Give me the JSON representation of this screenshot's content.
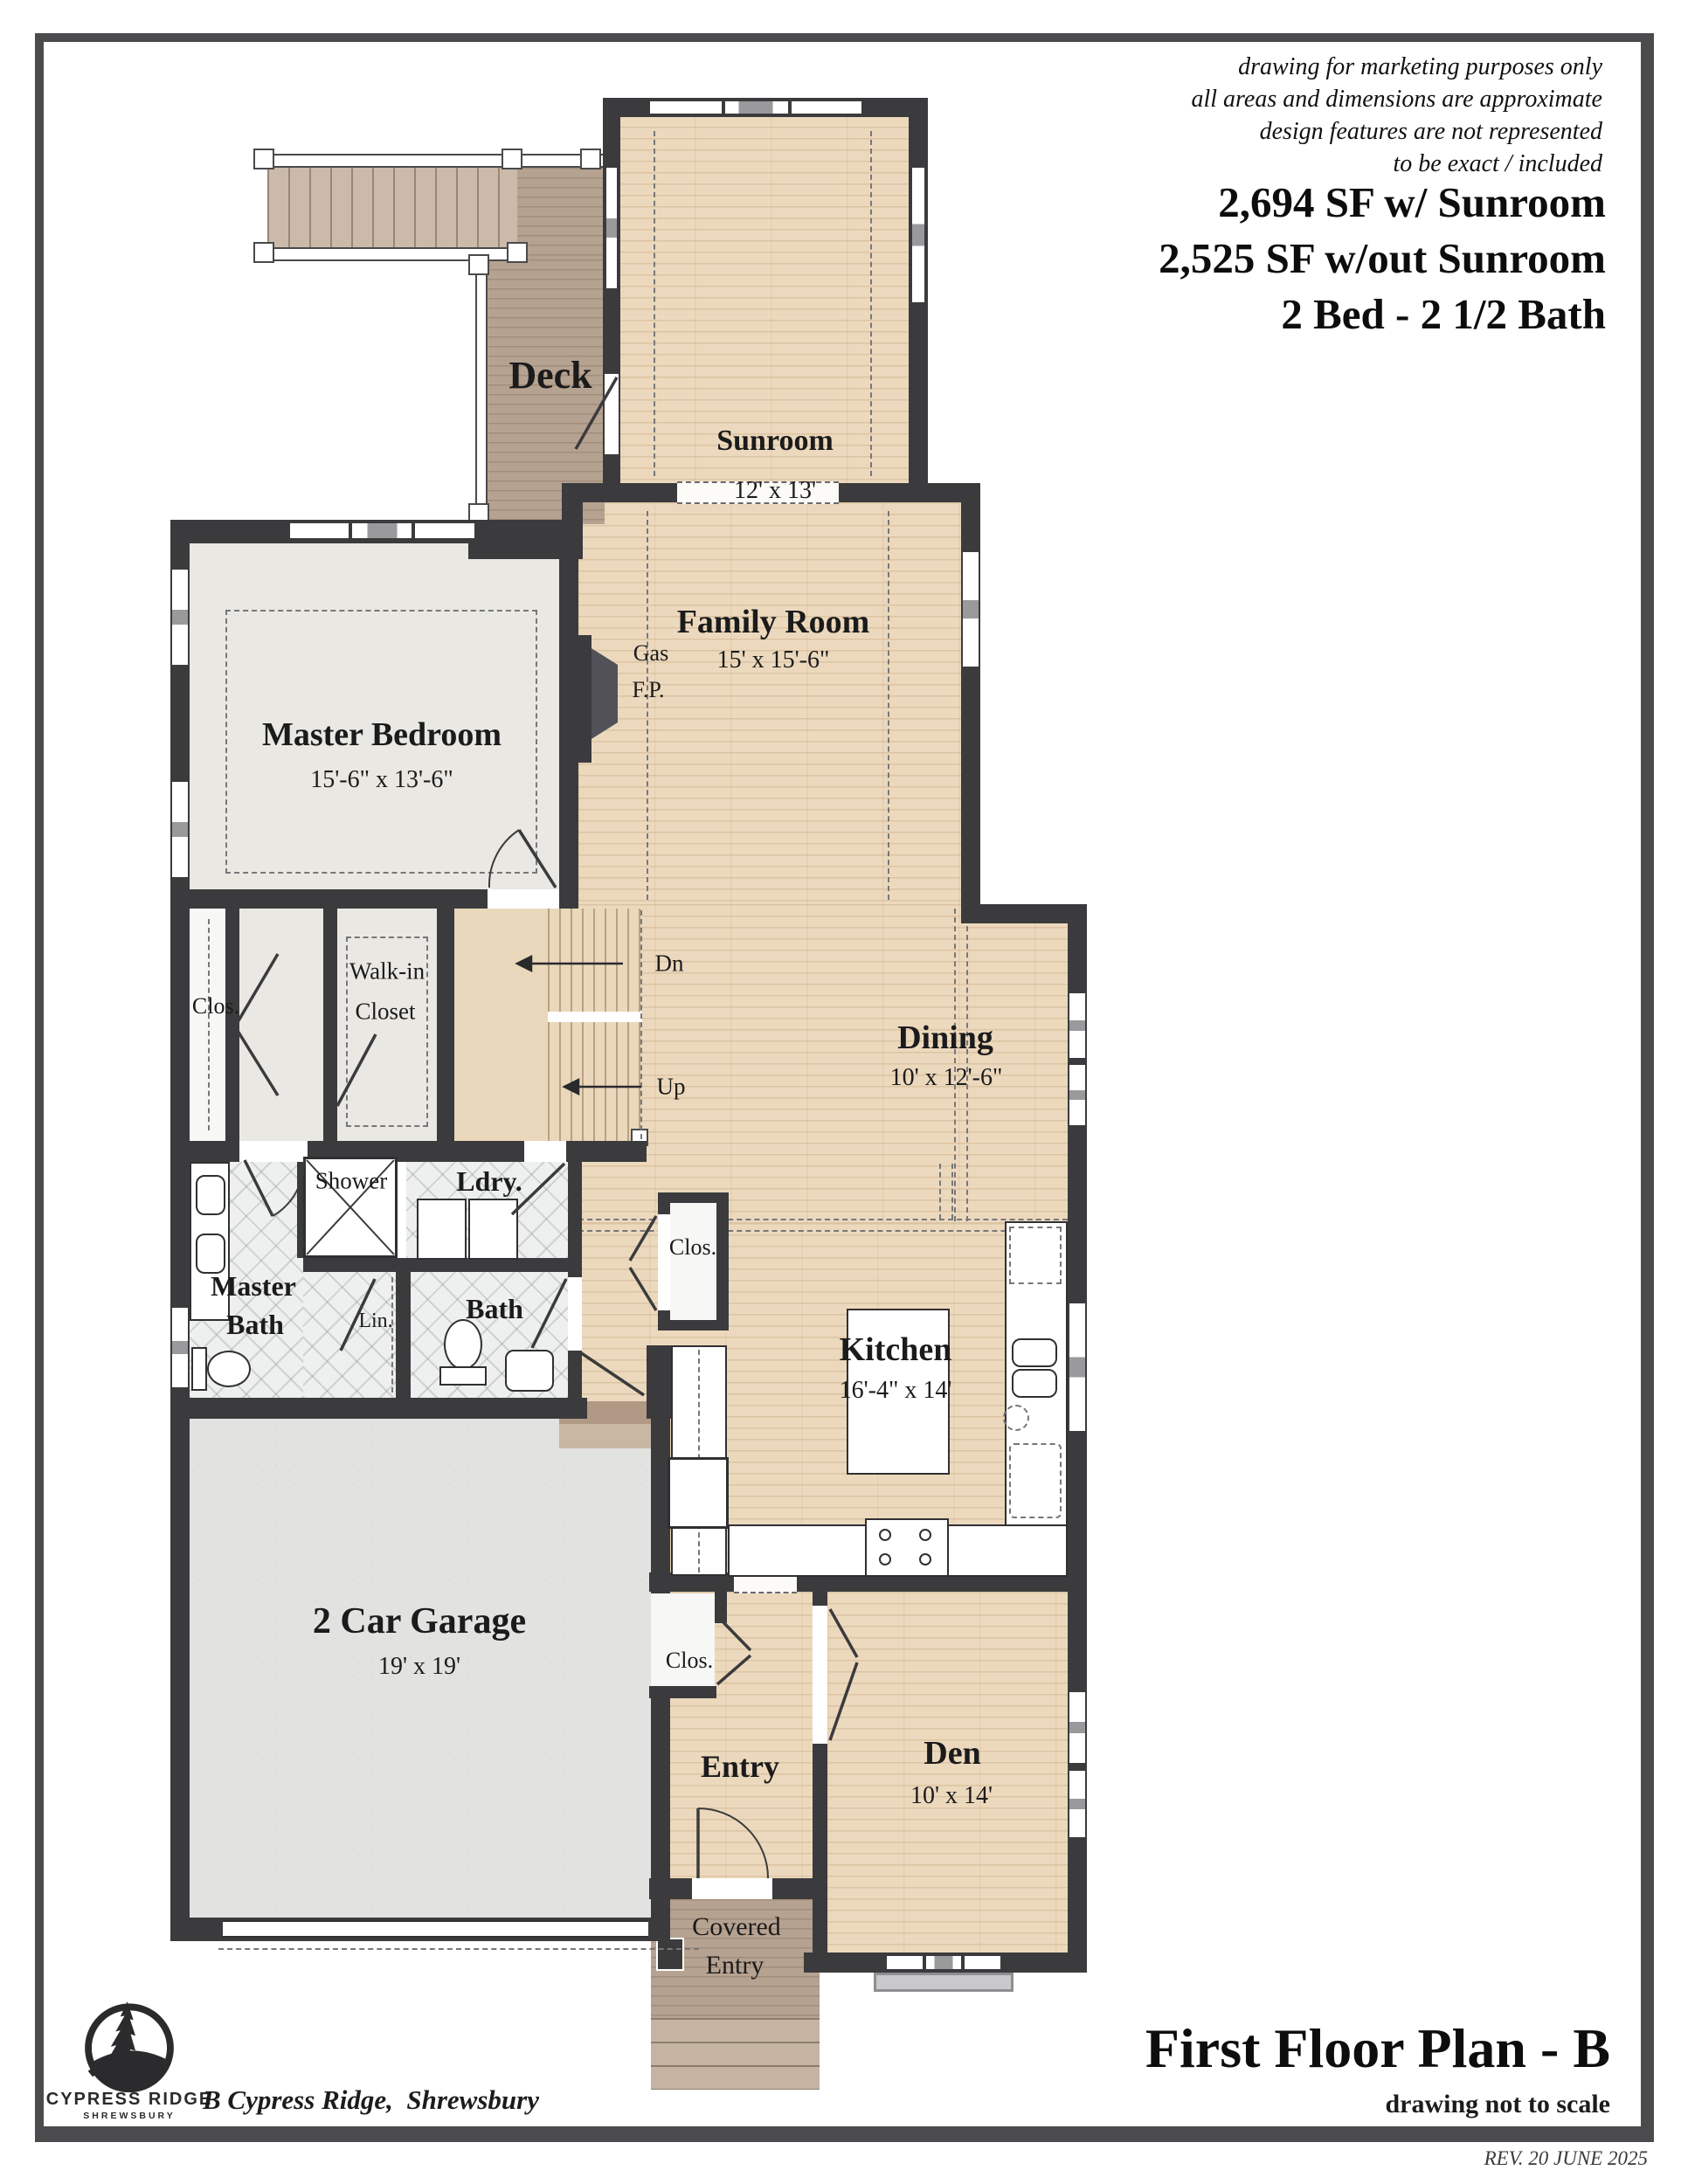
{
  "header": {
    "disclaimer_lines": [
      "drawing for marketing purposes only",
      "all areas and dimensions are approximate",
      "design features are not represented",
      "to be exact / included"
    ],
    "area_with_sunroom": "2,694 SF w/ Sunroom",
    "area_without_sunroom": "2,525 SF w/out Sunroom",
    "bed_bath": "2 Bed - 2 1/2 Bath"
  },
  "rooms": {
    "sunroom": {
      "name": "Sunroom",
      "dims": "12' x 13'"
    },
    "deck": {
      "name": "Deck"
    },
    "family_room": {
      "name": "Family Room",
      "dims": "15' x 15'-6\""
    },
    "master_bedroom": {
      "name": "Master Bedroom",
      "dims": "15'-6\" x 13'-6\""
    },
    "gas_fp": {
      "line1": "Gas",
      "line2": "F.P."
    },
    "closet_master": {
      "name": "Clos."
    },
    "walk_in_closet": {
      "line1": "Walk-in",
      "line2": "Closet"
    },
    "stairs": {
      "down": "Dn",
      "up": "Up"
    },
    "dining": {
      "name": "Dining",
      "dims": "10' x 12'-6\""
    },
    "laundry": {
      "name": "Ldry."
    },
    "shower": {
      "name": "Shower"
    },
    "master_bath": {
      "line1": "Master",
      "line2": "Bath"
    },
    "linen": {
      "name": "Lin."
    },
    "bath": {
      "name": "Bath"
    },
    "closet_hall": {
      "name": "Clos."
    },
    "kitchen": {
      "name": "Kitchen",
      "dims": "16'-4\" x 14'"
    },
    "garage": {
      "name": "2 Car Garage",
      "dims": "19' x 19'"
    },
    "closet_entry": {
      "name": "Clos."
    },
    "entry": {
      "name": "Entry"
    },
    "den": {
      "name": "Den",
      "dims": "10' x 14'"
    },
    "covered_entry": {
      "line1": "Covered",
      "line2": "Entry"
    }
  },
  "footer": {
    "logo_name": "CYPRESS RIDGE",
    "logo_sub": "SHREWSBURY",
    "address": "B Cypress Ridge,  Shrewsbury",
    "plan_title": "First Floor Plan - B",
    "scale_note": "drawing not to scale",
    "revision": "REV. 20 JUNE 2025"
  },
  "colors": {
    "wall": "#3b3b3d",
    "wood": "#ecd9bd",
    "carpet": "#e9e8e3",
    "garage-floor": "#e2e2e0",
    "deck": "#b6a290",
    "tile": "#eef0ef",
    "border-frame": "#4b4b4d"
  }
}
